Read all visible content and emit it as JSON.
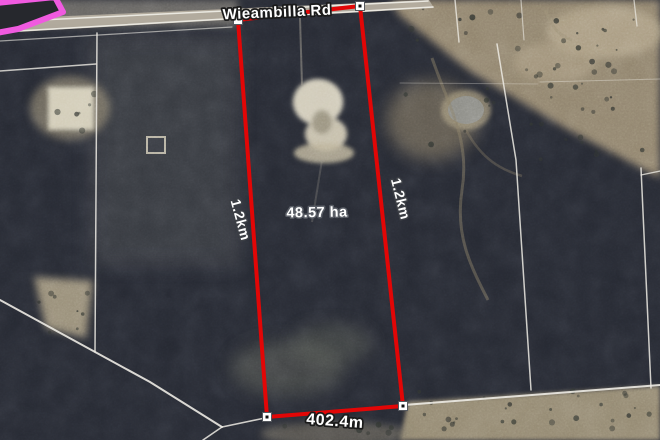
{
  "map": {
    "road_name": "Wieambilla Rd",
    "parcel": {
      "area_label": "48.57 ha",
      "side_left_label": "1.2km",
      "side_right_label": "1.2km",
      "side_bottom_label": "402.4m"
    },
    "colors": {
      "boundary_red": "#e20606",
      "highlight_pink": "#f05ae0",
      "label_white": "#ffffff"
    }
  }
}
